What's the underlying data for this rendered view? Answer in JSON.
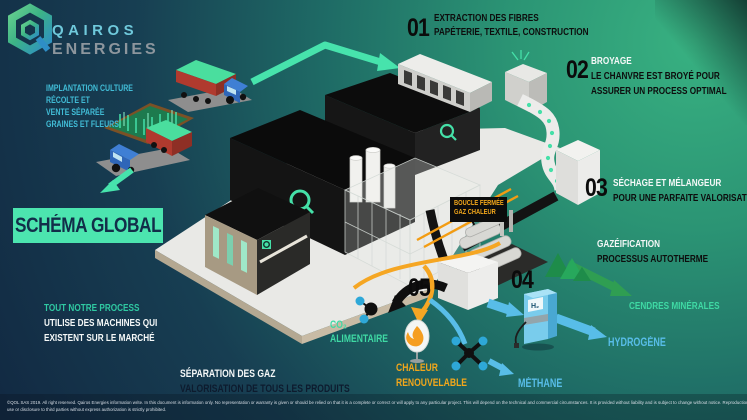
{
  "brand": {
    "line1": "QAIROS",
    "line2": "ENERGIES"
  },
  "banner": {
    "label": "SCHÉMA GLOBAL"
  },
  "left_block": {
    "line1": "IMPLANTATION CULTURE",
    "line2": "RÉCOLTE  ET",
    "line3": "VENTE SÉPARÉE",
    "line4": "GRAINES ET FLEURS"
  },
  "note": {
    "highlight": "TOUT NOTRE PROCESS",
    "line2": "UTILISE DES MACHINES QUI",
    "line3": "EXISTENT SUR LE MARCHÉ"
  },
  "steps": [
    {
      "number": "01",
      "title": "EXTRACTION DES FIBRES",
      "desc1": "PAPÉTERIE, TEXTILE, CONSTRUCTION"
    },
    {
      "number": "02",
      "title": "BROYAGE",
      "desc1": "LE CHANVRE EST BROYÉ POUR",
      "desc2": "ASSURER UN PROCESS OPTIMAL"
    },
    {
      "number": "03",
      "title": "SÉCHAGE ET MÉLANGEUR",
      "desc1": "POUR UNE PARFAITE VALORISATION"
    },
    {
      "number": "04"
    },
    {
      "number": "05"
    }
  ],
  "gazeification": {
    "title": "GAZÉIFICATION",
    "subtitle": "PROCESSUS AUTOTHERME"
  },
  "separation": {
    "title": "SÉPARATION DES GAZ",
    "subtitle": "VALORISATION DE TOUS LES PRODUITS"
  },
  "loop_badge": {
    "line1": "BOUCLE FERMÉE",
    "line2": "GAZ CHALEUR"
  },
  "outputs": {
    "cendres": "CENDRES MINÉRALES",
    "hydrogene": "HYDROGÈNE",
    "methane": "MÉTHANE",
    "co2_main": "CO₂",
    "co2_sub": "ALIMENTAIRE",
    "chaleur_line1": "CHALEUR",
    "chaleur_line2": "RENOUVELABLE"
  },
  "pump_label": "H₂",
  "colors": {
    "accent_mint": "#45e0a8",
    "accent_cyan": "#41bcd6",
    "accent_orange": "#f2a71b",
    "accent_blue": "#58bde8",
    "arrow_dark_green": "#2f9e52",
    "banner_bg": "#4ce5af",
    "number_black": "#0b0b0b"
  },
  "footer": {
    "line1": "©QOL SAS 2019. All right reserved. Qairos Energies information write. In this document is information only. No representation or warranty is given or should be relied on that it is a complete or correct or will apply to any particular project. This will depend on the technical and commercial circumstances. It is provided without liability and is subject to change without notice. Reproduction",
    "line2": "use or disclosure to third parties without express authorization is strictly prohibited."
  }
}
